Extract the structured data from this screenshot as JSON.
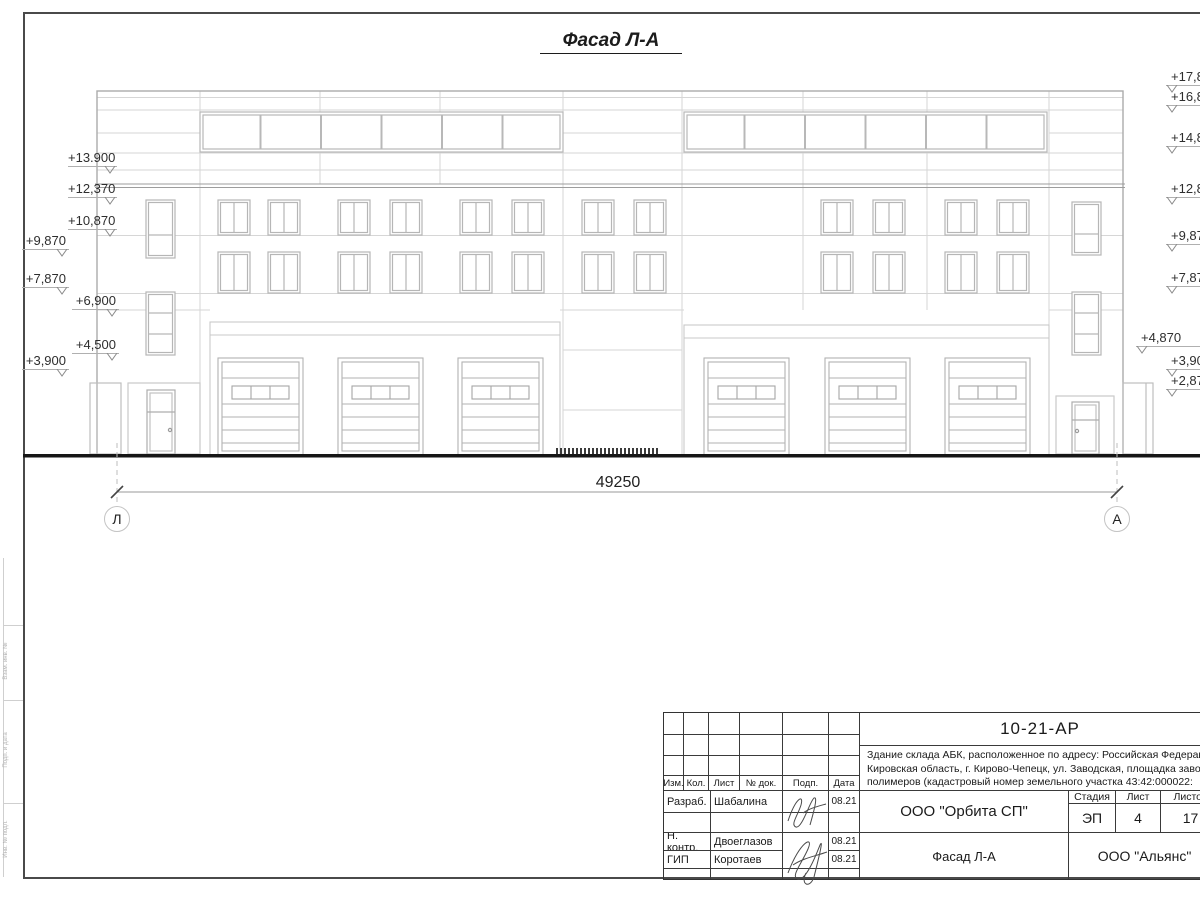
{
  "sheet": {
    "title": "Фасад Л-А"
  },
  "dimension": {
    "value": "49250"
  },
  "axes": {
    "left": "Л",
    "right": "А"
  },
  "elevations": {
    "left": [
      "+13.900",
      "+12,370",
      "+10,870",
      "+9,870",
      "+7,870",
      "+6,900",
      "+4,500",
      "+3,900"
    ],
    "right": [
      "+17,870",
      "+16,870",
      "+14,870",
      "+12,870",
      "+9,870",
      "+7,870",
      "+4,870",
      "+3,900",
      "+2,870"
    ]
  },
  "titleblock": {
    "code": "10-21-АР",
    "description_line1": "Здание склада АБК, расположенное по адресу: Российская Федерация,",
    "description_line2": "Кировская область, г. Кирово-Чепецк, ул. Заводская, площадка завода",
    "description_line3": "полимеров (кадастровый номер земельного участка 43:42:000022:",
    "change_header": {
      "izm": "Изм.",
      "kol": "Кол.",
      "list": "Лист",
      "doc": "№ док.",
      "podp": "Подп.",
      "data": "Дата"
    },
    "roles": [
      {
        "role": "Разраб.",
        "name": "Шабалина",
        "date": "08.21"
      },
      {
        "role": "Н. контр.",
        "name": "Двоеглазов",
        "date": "08.21"
      },
      {
        "role": "ГИП",
        "name": "Коротаев",
        "date": "08.21"
      }
    ],
    "org": "ООО \"Орбита СП\"",
    "stage_label": "Стадия",
    "sheet_label": "Лист",
    "sheets_label": "Листов",
    "stage": "ЭП",
    "sheet": "4",
    "sheets": "17",
    "drawing_title": "Фасад Л-А",
    "contractor": "ООО \"Альянс\""
  },
  "margin": {
    "label1": "Взам. инв. №",
    "label2": "Подп. и дата",
    "label3": "Инв. № подл."
  }
}
